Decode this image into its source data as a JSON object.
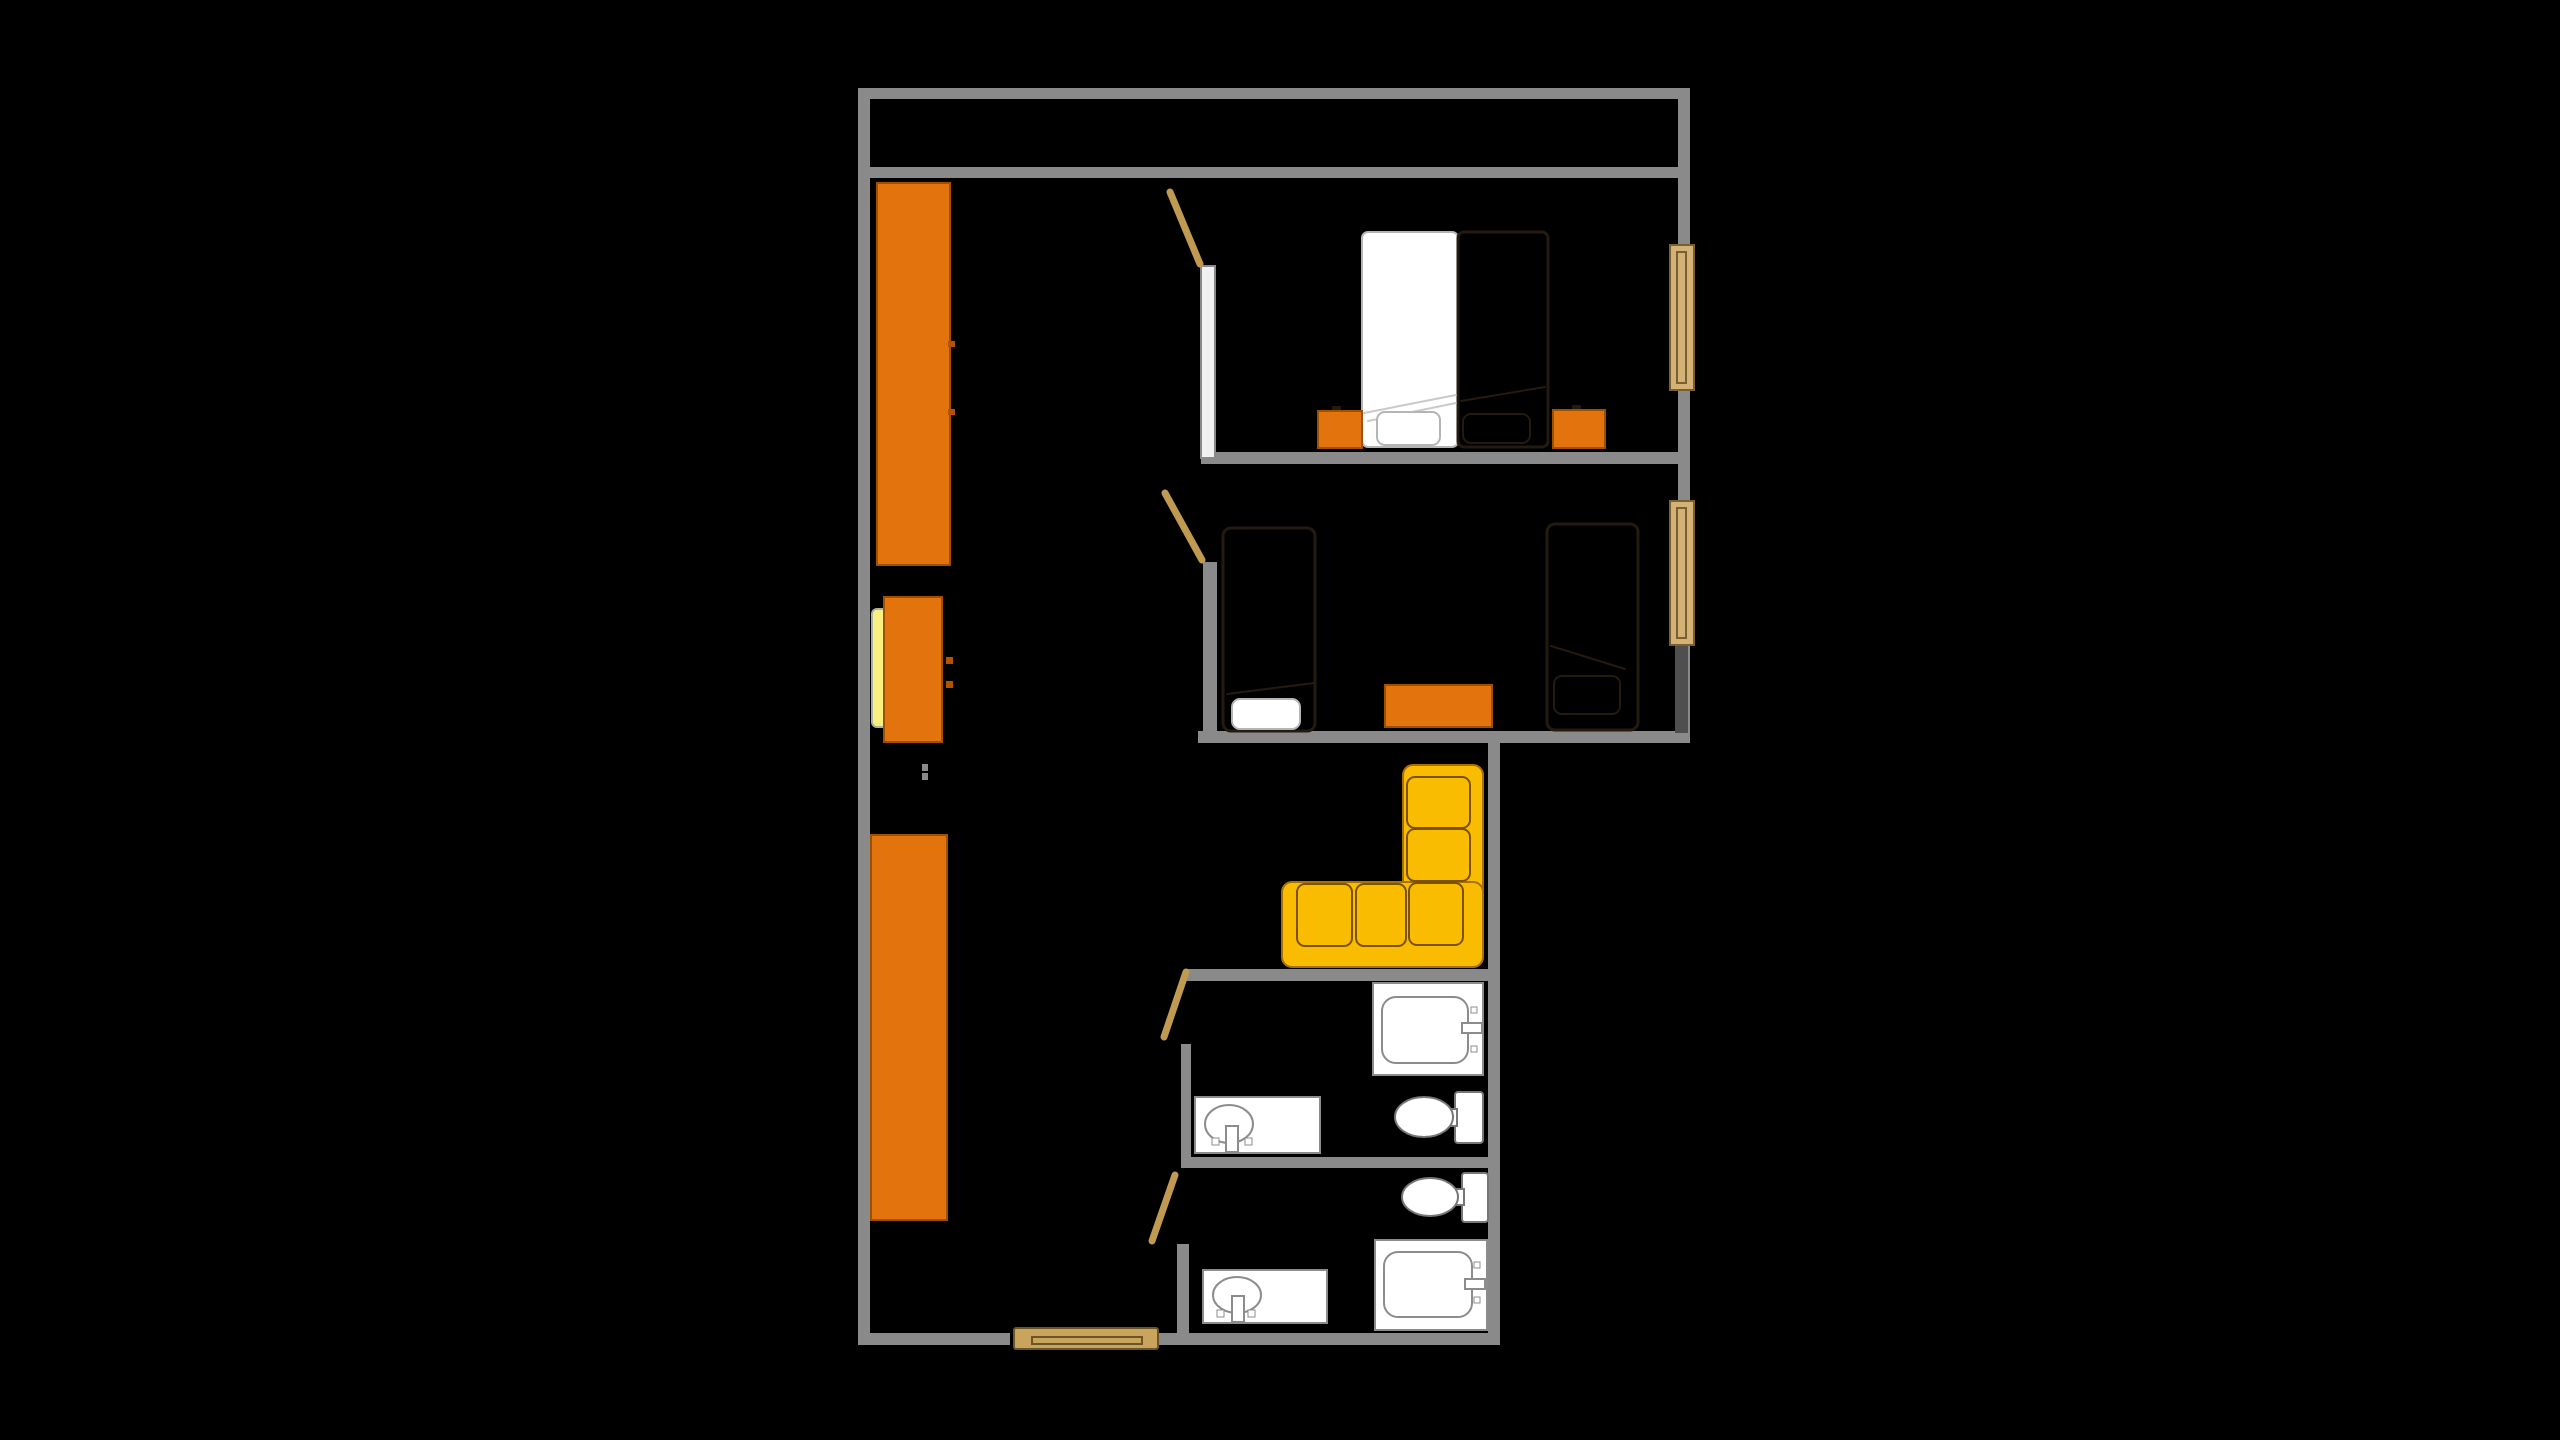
{
  "canvas": {
    "width": 2560,
    "height": 1440,
    "background": "#000000"
  },
  "palette": {
    "wall": "#8a8a8a",
    "wall_light": "#f1f1f1",
    "wall_dark": "#4f4f4f",
    "orange": "#e2730d",
    "orange_border": "#9e4f00",
    "orange_handle": "#b45400",
    "sofa_yellow": "#f9bc00",
    "sofa_border": "#a87000",
    "sofa_cushion_border": "#7a5200",
    "wood": "#c9a45c",
    "wood_dark": "#6b5426",
    "door_leaf": "#c09a50",
    "window_tan": "#d4b277",
    "window_border": "#7a5f30",
    "white": "#ffffff",
    "fixture_outline": "#8c8c8c",
    "fixture_outline_dark": "#777777",
    "bed_outline": "#241a10",
    "bed_light_outline": "#b5b5b5",
    "fold_light": "#c9c9c9",
    "pale_yellow": "#faf080",
    "pale_yellow_border": "#b0b0a0",
    "black": "#000000"
  },
  "elements": [
    {
      "name": "outer-wall-top",
      "kind": "rect",
      "x": 858,
      "y": 88,
      "w": 832,
      "h": 11,
      "fill": "$wall"
    },
    {
      "name": "outer-wall-left",
      "kind": "rect",
      "x": 858,
      "y": 88,
      "w": 12,
      "h": 1257,
      "fill": "$wall"
    },
    {
      "name": "outer-wall-right-upper",
      "kind": "rect",
      "x": 1678,
      "y": 88,
      "w": 12,
      "h": 655,
      "fill": "$wall"
    },
    {
      "name": "balcony-south-wall",
      "kind": "rect",
      "x": 870,
      "y": 167,
      "w": 808,
      "h": 11,
      "fill": "$wall"
    },
    {
      "name": "bedroom1-south-wall",
      "kind": "rect",
      "x": 1201,
      "y": 452,
      "w": 489,
      "h": 12,
      "fill": "$wall"
    },
    {
      "name": "bedroom2-south-wall",
      "kind": "rect",
      "x": 1198,
      "y": 731,
      "w": 492,
      "h": 12,
      "fill": "$wall"
    },
    {
      "name": "outer-wall-right-lower",
      "kind": "rect",
      "x": 1488,
      "y": 743,
      "w": 12,
      "h": 602,
      "fill": "$wall"
    },
    {
      "name": "entry-wall-left",
      "kind": "rect",
      "x": 858,
      "y": 1333,
      "w": 152,
      "h": 12,
      "fill": "$wall"
    },
    {
      "name": "entry-wall-right",
      "kind": "rect",
      "x": 1157,
      "y": 1333,
      "w": 343,
      "h": 12,
      "fill": "$wall"
    },
    {
      "name": "living-south-wall",
      "kind": "rect",
      "x": 1185,
      "y": 969,
      "w": 315,
      "h": 12,
      "fill": "$wall"
    },
    {
      "name": "bath1-left-wall",
      "kind": "rect",
      "x": 1181,
      "y": 1044,
      "w": 10,
      "h": 114,
      "fill": "$wall"
    },
    {
      "name": "bath-divider-wall",
      "kind": "rect",
      "x": 1181,
      "y": 1157,
      "w": 319,
      "h": 11,
      "fill": "$wall"
    },
    {
      "name": "bath2-left-wall",
      "kind": "rect",
      "x": 1177,
      "y": 1244,
      "w": 12,
      "h": 89,
      "fill": "$wall"
    },
    {
      "name": "bedroom1-left-wall",
      "kind": "rect",
      "x": 1201,
      "y": 266,
      "w": 14,
      "h": 192,
      "fill": "$wall_light",
      "stroke": "$wall",
      "sw": 2
    },
    {
      "name": "bedroom2-left-wall",
      "kind": "rect",
      "x": 1203,
      "y": 562,
      "w": 14,
      "h": 170,
      "fill": "$wall"
    },
    {
      "name": "bedroom2-window-lower-wall",
      "kind": "rect",
      "x": 1675,
      "y": 643,
      "w": 13,
      "h": 90,
      "fill": "$wall_dark"
    },
    {
      "name": "bedroom1-window",
      "kind": "rect",
      "x": 1670,
      "y": 245,
      "w": 24,
      "h": 145,
      "fill": "$window_tan",
      "stroke": "$window_border",
      "sw": 2
    },
    {
      "name": "bedroom1-window-inner",
      "kind": "rect",
      "x": 1677,
      "y": 252,
      "w": 9,
      "h": 131,
      "fill": "none",
      "stroke": "$window_border",
      "sw": 2
    },
    {
      "name": "bedroom2-window",
      "kind": "rect",
      "x": 1670,
      "y": 501,
      "w": 24,
      "h": 144,
      "fill": "$window_tan",
      "stroke": "$window_border",
      "sw": 2
    },
    {
      "name": "bedroom2-window-inner",
      "kind": "rect",
      "x": 1677,
      "y": 508,
      "w": 9,
      "h": 130,
      "fill": "none",
      "stroke": "$window_border",
      "sw": 2
    },
    {
      "name": "entrance-door",
      "kind": "rect",
      "x": 1014,
      "y": 1328,
      "w": 144,
      "h": 21,
      "fill": "$wood",
      "stroke": "$wood_dark",
      "sw": 2,
      "rx": 2
    },
    {
      "name": "entrance-door-inner",
      "kind": "rect",
      "x": 1032,
      "y": 1337,
      "w": 110,
      "h": 7,
      "fill": "none",
      "stroke": "$wood_dark",
      "sw": 2
    },
    {
      "name": "bedroom1-door",
      "kind": "line",
      "x1": 1170,
      "y1": 192,
      "x2": 1200,
      "y2": 264,
      "stroke": "$door_leaf",
      "sw": 7
    },
    {
      "name": "bedroom2-door",
      "kind": "line",
      "x1": 1165,
      "y1": 493,
      "x2": 1202,
      "y2": 560,
      "stroke": "$door_leaf",
      "sw": 7
    },
    {
      "name": "bath1-door",
      "kind": "line",
      "x1": 1164,
      "y1": 1037,
      "x2": 1186,
      "y2": 972,
      "stroke": "$door_leaf",
      "sw": 7
    },
    {
      "name": "bath2-door",
      "kind": "line",
      "x1": 1152,
      "y1": 1241,
      "x2": 1175,
      "y2": 1175,
      "stroke": "$door_leaf",
      "sw": 7
    },
    {
      "name": "hall-wardrobe-upper",
      "kind": "rect",
      "x": 877,
      "y": 183,
      "w": 73,
      "h": 382,
      "fill": "$orange",
      "stroke": "$orange_border",
      "sw": 2
    },
    {
      "name": "hall-wardrobe-upper-handle-1",
      "kind": "rect",
      "x": 948,
      "y": 341,
      "w": 7,
      "h": 6,
      "fill": "$orange_handle"
    },
    {
      "name": "hall-wardrobe-upper-handle-2",
      "kind": "rect",
      "x": 948,
      "y": 409,
      "w": 7,
      "h": 6,
      "fill": "$orange_handle"
    },
    {
      "name": "hall-dresser-seat",
      "kind": "rect",
      "x": 872,
      "y": 609,
      "w": 16,
      "h": 118,
      "fill": "$pale_yellow",
      "stroke": "$pale_yellow_border",
      "sw": 2,
      "rx": 5
    },
    {
      "name": "hall-dresser",
      "kind": "rect",
      "x": 884,
      "y": 597,
      "w": 58,
      "h": 145,
      "fill": "$orange",
      "stroke": "$orange_border",
      "sw": 2
    },
    {
      "name": "hall-dresser-handle-1",
      "kind": "rect",
      "x": 946,
      "y": 657,
      "w": 7,
      "h": 7,
      "fill": "$orange_handle"
    },
    {
      "name": "hall-dresser-handle-2",
      "kind": "rect",
      "x": 946,
      "y": 681,
      "w": 7,
      "h": 7,
      "fill": "$orange_handle"
    },
    {
      "name": "hall-door-stop-1",
      "kind": "rect",
      "x": 922,
      "y": 764,
      "w": 6,
      "h": 7,
      "fill": "$wall"
    },
    {
      "name": "hall-door-stop-2",
      "kind": "rect",
      "x": 922,
      "y": 773,
      "w": 6,
      "h": 7,
      "fill": "$wall"
    },
    {
      "name": "hall-wardrobe-lower",
      "kind": "rect",
      "x": 871,
      "y": 835,
      "w": 76,
      "h": 385,
      "fill": "$orange",
      "stroke": "$orange_border",
      "sw": 2
    },
    {
      "name": "bedroom1-bed-blanket-half",
      "kind": "rect",
      "x": 1362,
      "y": 232,
      "w": 96,
      "h": 215,
      "fill": "$white",
      "stroke": "$bed_light_outline",
      "sw": 2,
      "rx": 6
    },
    {
      "name": "bedroom1-bed-frame-half",
      "kind": "rect",
      "x": 1458,
      "y": 232,
      "w": 90,
      "h": 215,
      "fill": "$black",
      "stroke": "$bed_outline",
      "sw": 3,
      "rx": 6
    },
    {
      "name": "bedroom1-bed-fold-light-1",
      "kind": "line",
      "x1": 1364,
      "y1": 413,
      "x2": 1456,
      "y2": 395,
      "stroke": "$fold_light",
      "sw": 2
    },
    {
      "name": "bedroom1-bed-fold-light-2",
      "kind": "line",
      "x1": 1368,
      "y1": 421,
      "x2": 1456,
      "y2": 403,
      "stroke": "$fold_light",
      "sw": 2
    },
    {
      "name": "bedroom1-bed-fold-dark",
      "kind": "line",
      "x1": 1461,
      "y1": 401,
      "x2": 1545,
      "y2": 387,
      "stroke": "$bed_outline",
      "sw": 2
    },
    {
      "name": "bedroom1-pillow-left",
      "kind": "rect",
      "x": 1377,
      "y": 412,
      "w": 63,
      "h": 33,
      "fill": "$white",
      "stroke": "$bed_light_outline",
      "sw": 2,
      "rx": 8
    },
    {
      "name": "bedroom1-pillow-right",
      "kind": "rect",
      "x": 1463,
      "y": 414,
      "w": 67,
      "h": 29,
      "fill": "$black",
      "stroke": "$bed_outline",
      "sw": 2,
      "rx": 8
    },
    {
      "name": "bedroom1-nightstand-left",
      "kind": "rect",
      "x": 1318,
      "y": 411,
      "w": 44,
      "h": 37,
      "fill": "$orange",
      "stroke": "$orange_border",
      "sw": 2
    },
    {
      "name": "bedroom1-nightstand-right",
      "kind": "rect",
      "x": 1553,
      "y": 410,
      "w": 52,
      "h": 38,
      "fill": "$orange",
      "stroke": "$orange_border",
      "sw": 2
    },
    {
      "name": "bedroom1-nightstand-left-handle",
      "kind": "rect",
      "x": 1332,
      "y": 406,
      "w": 9,
      "h": 4,
      "fill": "$bed_outline"
    },
    {
      "name": "bedroom1-nightstand-right-handle",
      "kind": "rect",
      "x": 1572,
      "y": 405,
      "w": 9,
      "h": 4,
      "fill": "$bed_outline"
    },
    {
      "name": "bedroom2-bed-left",
      "kind": "rect",
      "x": 1223,
      "y": 528,
      "w": 92,
      "h": 203,
      "fill": "$black",
      "stroke": "$bed_outline",
      "sw": 3,
      "rx": 8
    },
    {
      "name": "bedroom2-bed-left-fold",
      "kind": "line",
      "x1": 1227,
      "y1": 694,
      "x2": 1314,
      "y2": 683,
      "stroke": "$bed_outline",
      "sw": 2
    },
    {
      "name": "bedroom2-bed-left-pillow",
      "kind": "rect",
      "x": 1232,
      "y": 699,
      "w": 68,
      "h": 30,
      "fill": "$white",
      "stroke": "$bed_light_outline",
      "sw": 2,
      "rx": 8
    },
    {
      "name": "bedroom2-table",
      "kind": "rect",
      "x": 1385,
      "y": 685,
      "w": 107,
      "h": 42,
      "fill": "$orange",
      "stroke": "$orange_border",
      "sw": 2
    },
    {
      "name": "bedroom2-bed-right",
      "kind": "rect",
      "x": 1547,
      "y": 524,
      "w": 91,
      "h": 206,
      "fill": "$black",
      "stroke": "$bed_outline",
      "sw": 3,
      "rx": 8
    },
    {
      "name": "bedroom2-bed-right-fold",
      "kind": "line",
      "x1": 1551,
      "y1": 646,
      "x2": 1625,
      "y2": 669,
      "stroke": "$bed_outline",
      "sw": 2
    },
    {
      "name": "bedroom2-bed-right-pillow",
      "kind": "rect",
      "x": 1554,
      "y": 676,
      "w": 66,
      "h": 38,
      "fill": "none",
      "stroke": "$bed_outline",
      "sw": 2,
      "rx": 8
    },
    {
      "name": "sofa-arm-vertical",
      "kind": "rect",
      "x": 1403,
      "y": 765,
      "w": 80,
      "h": 202,
      "fill": "$sofa_yellow",
      "stroke": "$sofa_border",
      "sw": 2,
      "rx": 10
    },
    {
      "name": "sofa-arm-horizontal",
      "kind": "rect",
      "x": 1282,
      "y": 882,
      "w": 201,
      "h": 85,
      "fill": "$sofa_yellow",
      "stroke": "$sofa_border",
      "sw": 2,
      "rx": 10
    },
    {
      "name": "sofa-cushion-right-1",
      "kind": "rect",
      "x": 1407,
      "y": 777,
      "w": 63,
      "h": 51,
      "fill": "$sofa_yellow",
      "stroke": "$sofa_cushion_border",
      "sw": 2,
      "rx": 8
    },
    {
      "name": "sofa-cushion-right-2",
      "kind": "rect",
      "x": 1407,
      "y": 829,
      "w": 63,
      "h": 52,
      "fill": "$sofa_yellow",
      "stroke": "$sofa_cushion_border",
      "sw": 2,
      "rx": 8
    },
    {
      "name": "sofa-cushion-bottom-1",
      "kind": "rect",
      "x": 1297,
      "y": 884,
      "w": 55,
      "h": 62,
      "fill": "$sofa_yellow",
      "stroke": "$sofa_cushion_border",
      "sw": 2,
      "rx": 8
    },
    {
      "name": "sofa-cushion-bottom-2",
      "kind": "rect",
      "x": 1356,
      "y": 884,
      "w": 50,
      "h": 62,
      "fill": "$sofa_yellow",
      "stroke": "$sofa_cushion_border",
      "sw": 2,
      "rx": 8
    },
    {
      "name": "sofa-cushion-bottom-3",
      "kind": "rect",
      "x": 1409,
      "y": 883,
      "w": 54,
      "h": 62,
      "fill": "$sofa_yellow",
      "stroke": "$sofa_cushion_border",
      "sw": 2,
      "rx": 8
    },
    {
      "name": "bath1-bathtub",
      "kind": "rect",
      "x": 1373,
      "y": 983,
      "w": 110,
      "h": 92,
      "fill": "$white",
      "stroke": "$fixture_outline",
      "sw": 2
    },
    {
      "name": "bath1-bathtub-basin",
      "kind": "rect",
      "x": 1382,
      "y": 997,
      "w": 86,
      "h": 66,
      "fill": "$white",
      "stroke": "$fixture_outline",
      "sw": 2,
      "rx": 14
    },
    {
      "name": "bath1-bathtub-faucet",
      "kind": "rect",
      "x": 1462,
      "y": 1023,
      "w": 20,
      "h": 10,
      "fill": "$white",
      "stroke": "$fixture_outline",
      "sw": 2
    },
    {
      "name": "bath1-bathtub-jet-1",
      "kind": "rect",
      "x": 1471,
      "y": 1007,
      "w": 6,
      "h": 6,
      "fill": "$white",
      "stroke": "$fixture_outline",
      "sw": 1
    },
    {
      "name": "bath1-bathtub-jet-2",
      "kind": "rect",
      "x": 1471,
      "y": 1046,
      "w": 6,
      "h": 6,
      "fill": "$white",
      "stroke": "$fixture_outline",
      "sw": 1
    },
    {
      "name": "bath1-toilet-tank",
      "kind": "rect",
      "x": 1455,
      "y": 1092,
      "w": 28,
      "h": 51,
      "fill": "$white",
      "stroke": "$fixture_outline_dark",
      "sw": 2,
      "rx": 3
    },
    {
      "name": "bath1-toilet-connector",
      "kind": "rect",
      "x": 1448,
      "y": 1109,
      "w": 9,
      "h": 17,
      "fill": "$white",
      "stroke": "$fixture_outline_dark",
      "sw": 2
    },
    {
      "name": "bath1-toilet-bowl",
      "kind": "ellipse",
      "cx": 1424,
      "cy": 1117,
      "rx": 29,
      "ry": 20,
      "fill": "$white",
      "stroke": "$fixture_outline_dark",
      "sw": 2
    },
    {
      "name": "bath1-sink-counter",
      "kind": "rect",
      "x": 1195,
      "y": 1097,
      "w": 125,
      "h": 56,
      "fill": "$white",
      "stroke": "$fixture_outline",
      "sw": 2
    },
    {
      "name": "bath1-sink-basin",
      "kind": "ellipse",
      "cx": 1229,
      "cy": 1124,
      "rx": 24,
      "ry": 19,
      "fill": "$white",
      "stroke": "$fixture_outline",
      "sw": 2
    },
    {
      "name": "bath1-sink-faucet",
      "kind": "rect",
      "x": 1226,
      "y": 1126,
      "w": 12,
      "h": 26,
      "fill": "$white",
      "stroke": "$fixture_outline",
      "sw": 2
    },
    {
      "name": "bath1-sink-handle-1",
      "kind": "rect",
      "x": 1212,
      "y": 1138,
      "w": 7,
      "h": 7,
      "fill": "$white",
      "stroke": "$fixture_outline",
      "sw": 1
    },
    {
      "name": "bath1-sink-handle-2",
      "kind": "rect",
      "x": 1245,
      "y": 1138,
      "w": 7,
      "h": 7,
      "fill": "$white",
      "stroke": "$fixture_outline",
      "sw": 1
    },
    {
      "name": "bath2-toilet-tank",
      "kind": "rect",
      "x": 1462,
      "y": 1173,
      "w": 26,
      "h": 49,
      "fill": "$white",
      "stroke": "$fixture_outline_dark",
      "sw": 2,
      "rx": 3
    },
    {
      "name": "bath2-toilet-connector",
      "kind": "rect",
      "x": 1455,
      "y": 1189,
      "w": 9,
      "h": 16,
      "fill": "$white",
      "stroke": "$fixture_outline_dark",
      "sw": 2
    },
    {
      "name": "bath2-toilet-bowl",
      "kind": "ellipse",
      "cx": 1430,
      "cy": 1197,
      "rx": 28,
      "ry": 19,
      "fill": "$white",
      "stroke": "$fixture_outline_dark",
      "sw": 2
    },
    {
      "name": "bath2-bathtub",
      "kind": "rect",
      "x": 1375,
      "y": 1240,
      "w": 112,
      "h": 90,
      "fill": "$white",
      "stroke": "$fixture_outline",
      "sw": 2
    },
    {
      "name": "bath2-bathtub-basin",
      "kind": "rect",
      "x": 1384,
      "y": 1252,
      "w": 88,
      "h": 65,
      "fill": "$white",
      "stroke": "$fixture_outline",
      "sw": 2,
      "rx": 14
    },
    {
      "name": "bath2-bathtub-faucet",
      "kind": "rect",
      "x": 1465,
      "y": 1279,
      "w": 20,
      "h": 10,
      "fill": "$white",
      "stroke": "$fixture_outline",
      "sw": 2
    },
    {
      "name": "bath2-bathtub-jet-1",
      "kind": "rect",
      "x": 1474,
      "y": 1262,
      "w": 6,
      "h": 6,
      "fill": "$white",
      "stroke": "$fixture_outline",
      "sw": 1
    },
    {
      "name": "bath2-bathtub-jet-2",
      "kind": "rect",
      "x": 1474,
      "y": 1297,
      "w": 6,
      "h": 6,
      "fill": "$white",
      "stroke": "$fixture_outline",
      "sw": 1
    },
    {
      "name": "bath2-sink-counter",
      "kind": "rect",
      "x": 1203,
      "y": 1270,
      "w": 124,
      "h": 53,
      "fill": "$white",
      "stroke": "$fixture_outline",
      "sw": 2
    },
    {
      "name": "bath2-sink-basin",
      "kind": "ellipse",
      "cx": 1237,
      "cy": 1295,
      "rx": 24,
      "ry": 18,
      "fill": "$white",
      "stroke": "$fixture_outline",
      "sw": 2
    },
    {
      "name": "bath2-sink-faucet",
      "kind": "rect",
      "x": 1232,
      "y": 1296,
      "w": 12,
      "h": 26,
      "fill": "$white",
      "stroke": "$fixture_outline",
      "sw": 2
    },
    {
      "name": "bath2-sink-handle-1",
      "kind": "rect",
      "x": 1217,
      "y": 1310,
      "w": 7,
      "h": 7,
      "fill": "$white",
      "stroke": "$fixture_outline",
      "sw": 1
    },
    {
      "name": "bath2-sink-handle-2",
      "kind": "rect",
      "x": 1248,
      "y": 1310,
      "w": 7,
      "h": 7,
      "fill": "$white",
      "stroke": "$fixture_outline",
      "sw": 1
    }
  ]
}
